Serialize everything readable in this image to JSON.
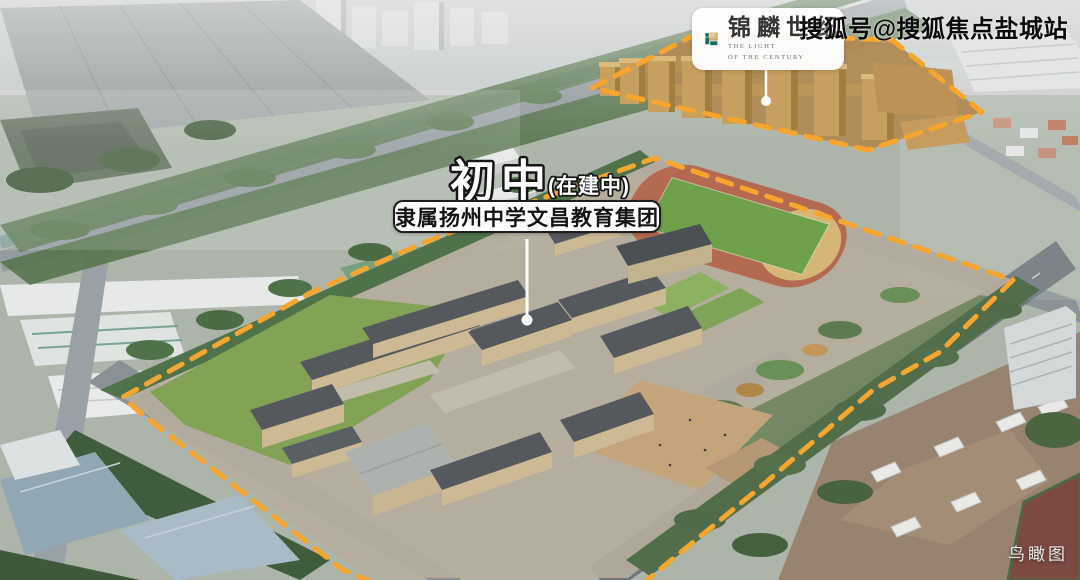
{
  "watermark": {
    "text": "搜狐号@搜狐焦点盐城站"
  },
  "logo": {
    "cn_name": "锦麟世纪",
    "en_line1": "THE LIGHT",
    "en_line2": "OF THE CENTURY"
  },
  "annotation": {
    "title": "初中",
    "status": "(在建中)",
    "subtitle": "隶属扬州中学文昌教育集团"
  },
  "caption": {
    "text": "鸟瞰图"
  },
  "colors": {
    "boundary": "#F6A62F",
    "label_outline": "#161616",
    "leader": "#FFFFFF",
    "logo_teal": "#176B66",
    "logo_gold": "#C79A5E"
  }
}
